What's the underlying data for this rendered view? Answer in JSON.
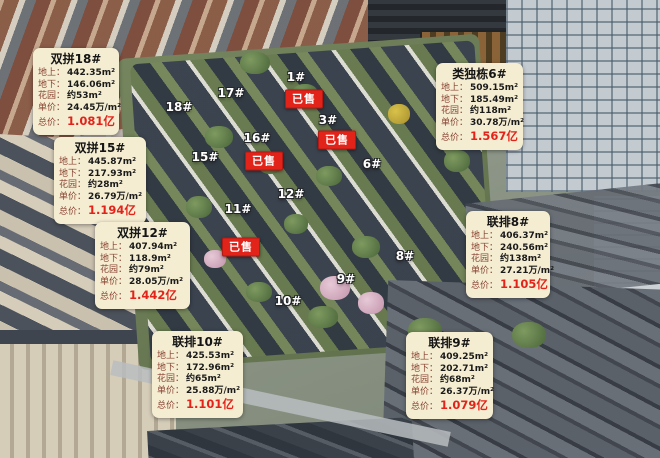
{
  "colors": {
    "info_box_bg": "#f4edd2",
    "row_label_text": "#8a4332",
    "row_value_text": "#1a1a1a",
    "total_price_text": "#e3231a",
    "sold_badge_bg": "#e2231a",
    "sold_badge_text": "#ffffff",
    "unit_label_text": "#ffffff"
  },
  "info_boxes": [
    {
      "title": "双拼18#",
      "rows": [
        {
          "label": "地上：",
          "value": "442.35m²"
        },
        {
          "label": "地下：",
          "value": "146.06m²"
        },
        {
          "label": "花园：",
          "value": "约53m²"
        },
        {
          "label": "单价：",
          "value": "24.45万/m²"
        },
        {
          "label": "总价：",
          "value": "1.081亿"
        }
      ]
    },
    {
      "title": "双拼15#",
      "rows": [
        {
          "label": "地上：",
          "value": "445.87m²"
        },
        {
          "label": "地下：",
          "value": "217.93m²"
        },
        {
          "label": "花园：",
          "value": "约28m²"
        },
        {
          "label": "单价：",
          "value": "26.79万/m²"
        },
        {
          "label": "总价：",
          "value": "1.194亿"
        }
      ]
    },
    {
      "title": "双拼12#",
      "rows": [
        {
          "label": "地上：",
          "value": "407.94m²"
        },
        {
          "label": "地下：",
          "value": "118.9m²"
        },
        {
          "label": "花园：",
          "value": "约79m²"
        },
        {
          "label": "单价：",
          "value": "28.05万/m²"
        },
        {
          "label": "总价：",
          "value": "1.442亿"
        }
      ]
    },
    {
      "title": "联排10#",
      "rows": [
        {
          "label": "地上：",
          "value": "425.53m²"
        },
        {
          "label": "地下：",
          "value": "172.96m²"
        },
        {
          "label": "花园：",
          "value": "约65m²"
        },
        {
          "label": "单价：",
          "value": "25.88万/m²"
        },
        {
          "label": "总价：",
          "value": "1.101亿"
        }
      ]
    },
    {
      "title": "类独栋6#",
      "rows": [
        {
          "label": "地上：",
          "value": "509.15m²"
        },
        {
          "label": "地下：",
          "value": "185.49m²"
        },
        {
          "label": "花园：",
          "value": "约118m²"
        },
        {
          "label": "单价：",
          "value": "30.78万/m²"
        },
        {
          "label": "总价：",
          "value": "1.567亿"
        }
      ]
    },
    {
      "title": "联排8#",
      "rows": [
        {
          "label": "地上：",
          "value": "406.37m²"
        },
        {
          "label": "地下：",
          "value": "240.56m²"
        },
        {
          "label": "花园：",
          "value": "约138m²"
        },
        {
          "label": "单价：",
          "value": "27.21万/m²"
        },
        {
          "label": "总价：",
          "value": "1.105亿"
        }
      ]
    },
    {
      "title": "联排9#",
      "rows": [
        {
          "label": "地上：",
          "value": "409.25m²"
        },
        {
          "label": "地下：",
          "value": "202.71m²"
        },
        {
          "label": "花园：",
          "value": "约68m²"
        },
        {
          "label": "单价：",
          "value": "26.37万/m²"
        },
        {
          "label": "总价：",
          "value": "1.079亿"
        }
      ]
    }
  ],
  "unit_labels": [
    "18#",
    "17#",
    "1#",
    "3#",
    "16#",
    "15#",
    "6#",
    "12#",
    "11#",
    "8#",
    "9#",
    "10#"
  ],
  "sold_badges": [
    {
      "text": "已售"
    },
    {
      "text": "已售"
    },
    {
      "text": "已售"
    },
    {
      "text": "已售"
    }
  ]
}
